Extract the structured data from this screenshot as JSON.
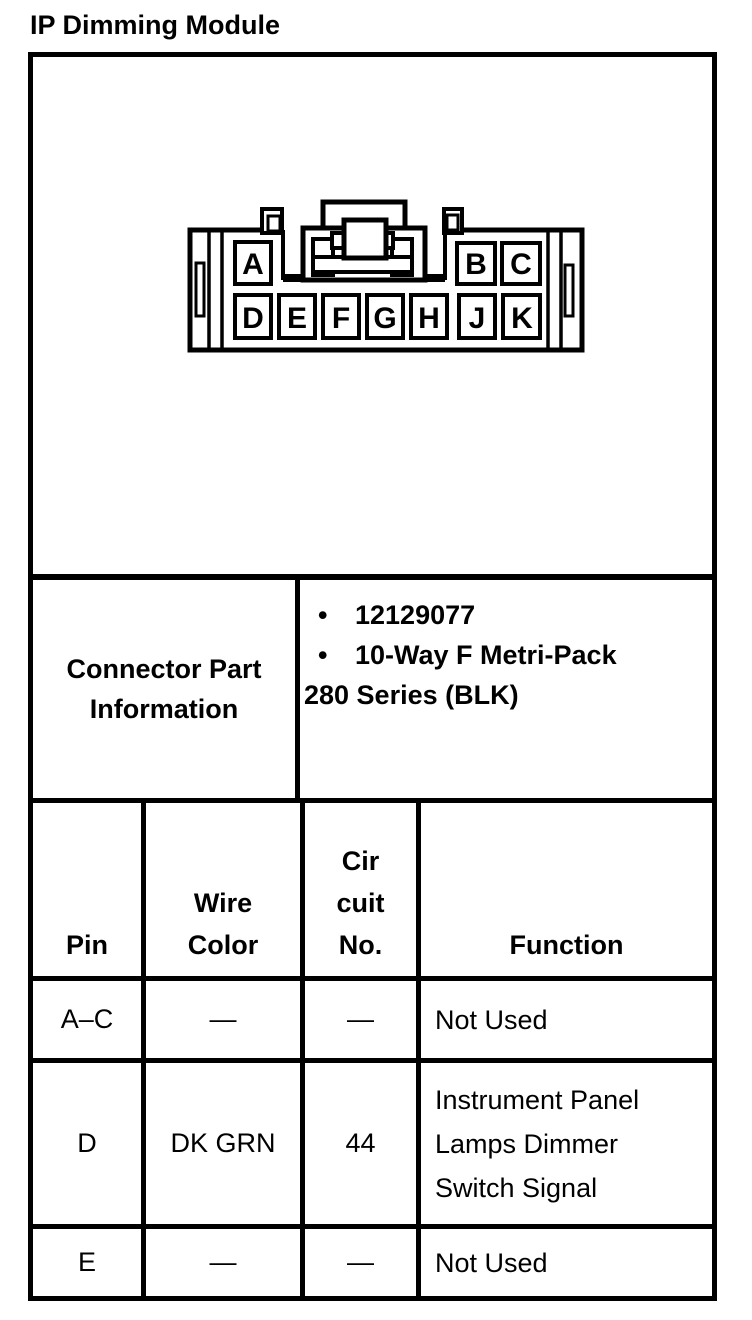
{
  "page": {
    "title": "IP Dimming Module"
  },
  "diagram": {
    "description": "Face view of 10-way connector with locking latch",
    "pins": {
      "top": [
        "A",
        "B",
        "C"
      ],
      "bottom": [
        "D",
        "E",
        "F",
        "G",
        "H",
        "J",
        "K"
      ]
    }
  },
  "connector_info": {
    "label": "Connector Part\nInformation",
    "items": [
      {
        "bullet": "•",
        "text": "12129077"
      },
      {
        "bullet": "•",
        "text": "10-Way F Metri-Pack"
      },
      {
        "bullet": "",
        "text": "280 Series (BLK)"
      }
    ]
  },
  "pin_table": {
    "headers": {
      "pin": "Pin",
      "wire_color": "Wire\nColor",
      "circuit_no": "Cir\ncuit\nNo.",
      "function": "Function"
    },
    "rows": [
      {
        "pin": "A–C",
        "wire_color": "—",
        "circuit_no": "—",
        "function": "Not Used"
      },
      {
        "pin": "D",
        "wire_color": "DK GRN",
        "circuit_no": "44",
        "function": "Instrument Panel\nLamps Dimmer\nSwitch Signal"
      },
      {
        "pin": "E",
        "wire_color": "—",
        "circuit_no": "—",
        "function": "Not Used"
      }
    ]
  },
  "colors": {
    "ink": "#000000",
    "paper": "#ffffff"
  }
}
